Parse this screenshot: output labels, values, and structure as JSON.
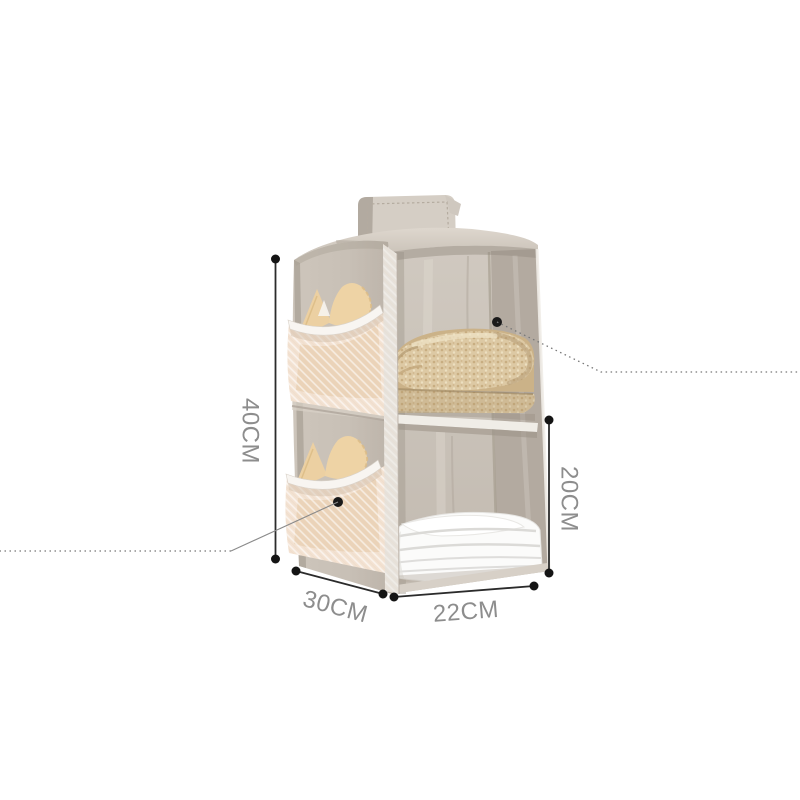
{
  "page": {
    "title": "Two-shelf hanging closet organizer — product photo with dimensions",
    "background": "#ffffff"
  },
  "annotations": {
    "height": "40CM",
    "depth": "30CM",
    "width": "22CM",
    "compartment_height": "20CM"
  },
  "product": {
    "description": "Grey-beige fabric hanging wardrobe organizer with two open shelves, side mesh pockets holding tan garments, a folded tan knit sweater on the top shelf and folded white clothes on the bottom shelf, hung by a top strap",
    "colors": {
      "fabric": "#c8c0b6",
      "fabric_light": "#d8d1c8",
      "interior_dark": "#b3aaa0",
      "mesh_pocket": "#f3e2d2",
      "mesh_trim": "#f8f5f1",
      "garment_tan": "#ecd0a2",
      "knit_sweater": "#ddc9a4",
      "white_clothes": "#fbfbfa",
      "dimension_line": "#2b2b2b",
      "dimension_dot": "#141414",
      "label_text": "#8d8d8d",
      "callout_line": "#777777"
    }
  }
}
